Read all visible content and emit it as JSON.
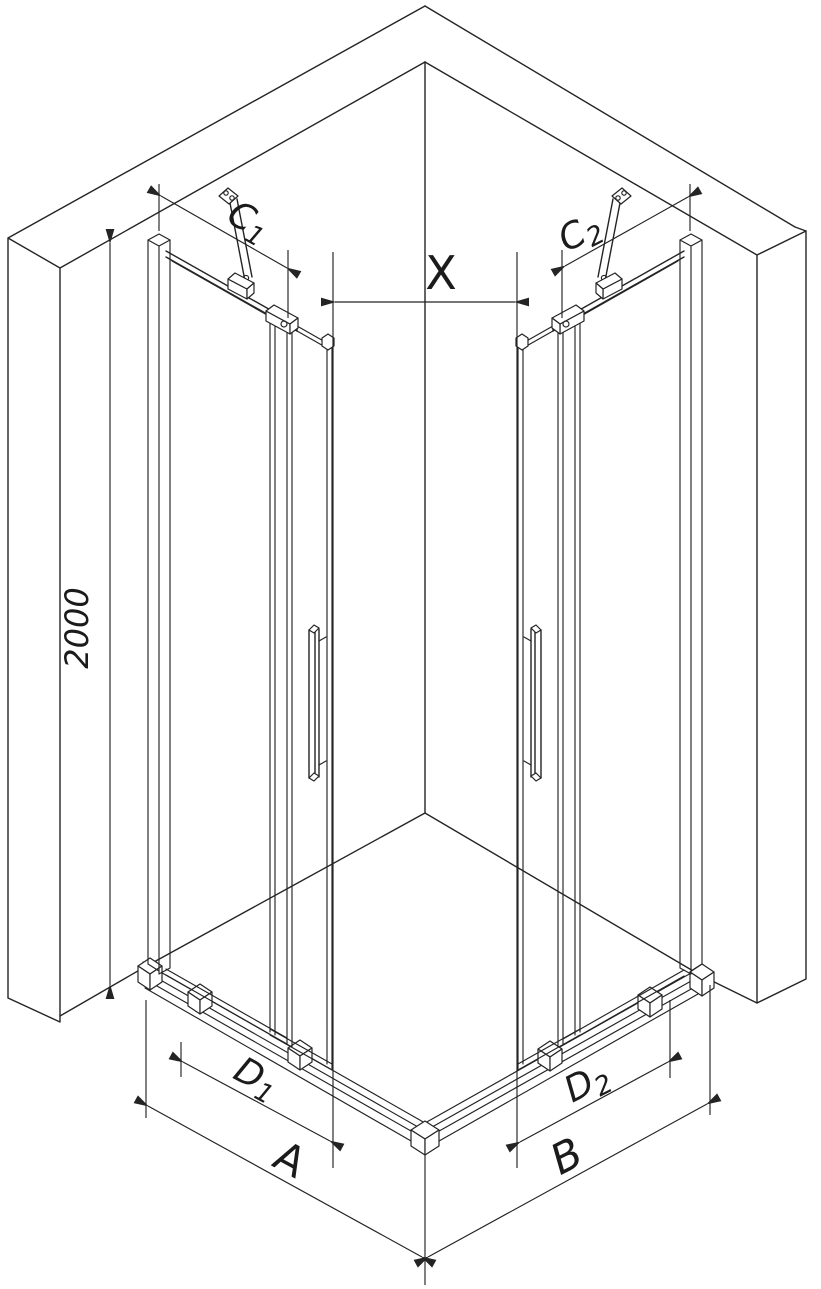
{
  "dims": {
    "height": "2000",
    "x": "X",
    "a": "A",
    "b": "B",
    "c1": {
      "main": "C",
      "sub": "1"
    },
    "c2": {
      "main": "C",
      "sub": "2"
    },
    "d1": {
      "main": "D",
      "sub": "1"
    },
    "d2": {
      "main": "D",
      "sub": "2"
    }
  },
  "colors": {
    "line": "#242424",
    "background": "#ffffff"
  }
}
